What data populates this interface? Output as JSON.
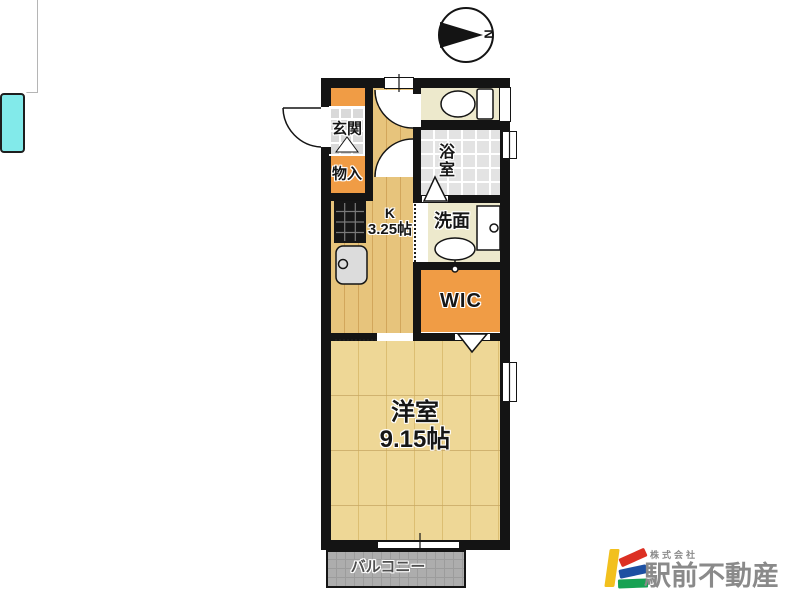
{
  "title": "apartment-floor-plan",
  "compass": {
    "north_label": "N",
    "orientation": "north-points-right"
  },
  "rooms": {
    "entrance": {
      "label": "玄関"
    },
    "storage": {
      "label": "物入"
    },
    "kitchen": {
      "label": "K",
      "size": "3.25帖"
    },
    "bathroom": {
      "label": "浴室"
    },
    "washroom": {
      "label": "洗面"
    },
    "wic": {
      "label": "WIC"
    },
    "western_room": {
      "label": "洋室",
      "size": "9.15帖"
    },
    "balcony": {
      "label": "バルコニー"
    }
  },
  "fixtures": [
    "toilet",
    "bathtub",
    "washbasin",
    "washing-machine-pan",
    "kitchen-sink",
    "gas-stove"
  ],
  "branding": {
    "company_prefix": "株式会社",
    "company_name": "駅前不動産",
    "text_color": "#8A8A8A",
    "logo_colors": {
      "yellow": "#F2C01E",
      "red": "#DC3023",
      "blue": "#1D50A2",
      "green": "#17A253"
    }
  },
  "palette": {
    "wall": "#141414",
    "wood_kitchen": "#E7C47C",
    "wood_room": "#EED796",
    "closet_orange": "#F09C45",
    "bathtub_cyan": "#82EAEA",
    "tile_gray": "#E3E3E3",
    "room_beige": "#EDE9CC",
    "balcony_gray": "#ADADAD"
  }
}
